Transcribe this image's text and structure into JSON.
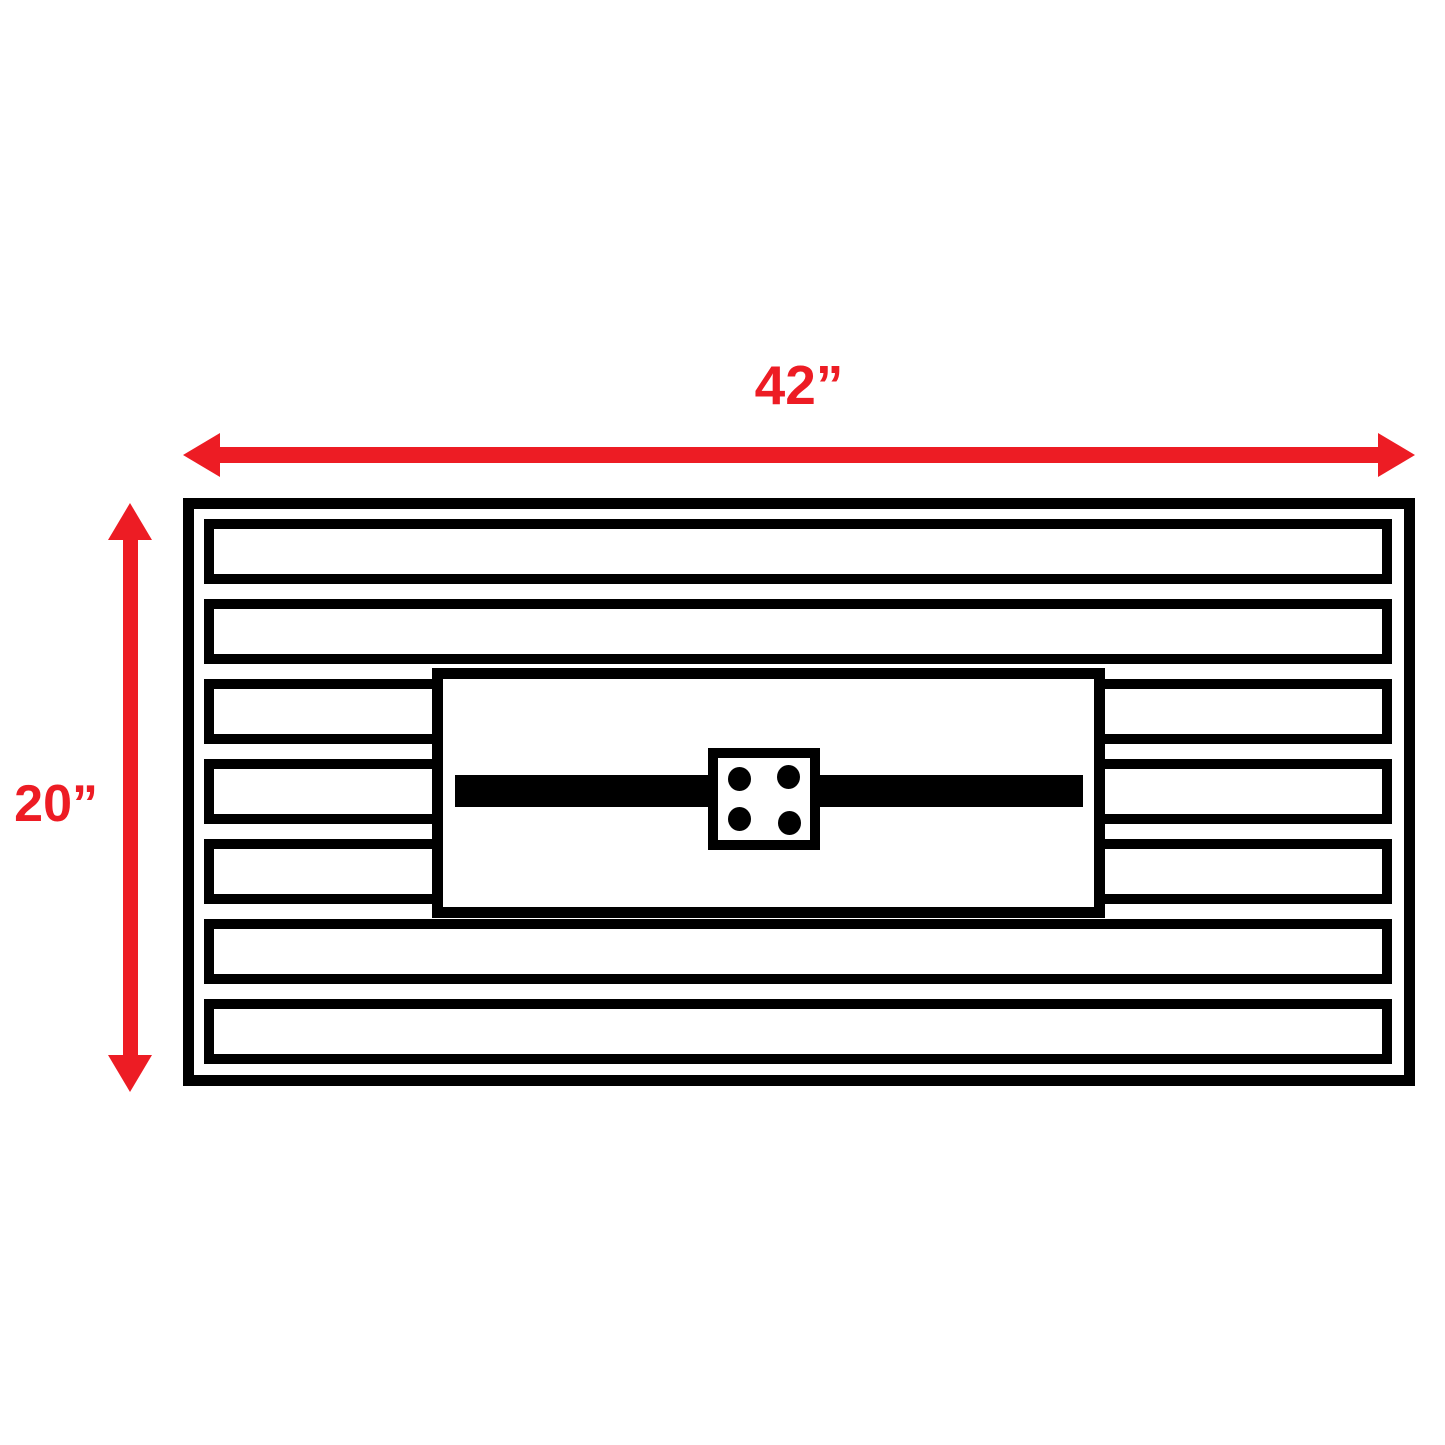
{
  "page": {
    "background": "#ffffff"
  },
  "diagram": {
    "name": "fire-pit-table-top-view-dimensions",
    "width_label": "42”",
    "height_label": "20”",
    "colors": {
      "dimension_red": "#ed1c24",
      "line_black": "#000000",
      "fill_white": "#ffffff"
    },
    "table": {
      "rows": [
        {
          "type": "full"
        },
        {
          "type": "full"
        },
        {
          "type": "split"
        },
        {
          "type": "split"
        },
        {
          "type": "split"
        },
        {
          "type": "full"
        },
        {
          "type": "full"
        }
      ],
      "igniter_dots": [
        {
          "x": 10,
          "y": 9
        },
        {
          "x": 59,
          "y": 7
        },
        {
          "x": 10,
          "y": 49
        },
        {
          "x": 60,
          "y": 53
        }
      ]
    }
  }
}
